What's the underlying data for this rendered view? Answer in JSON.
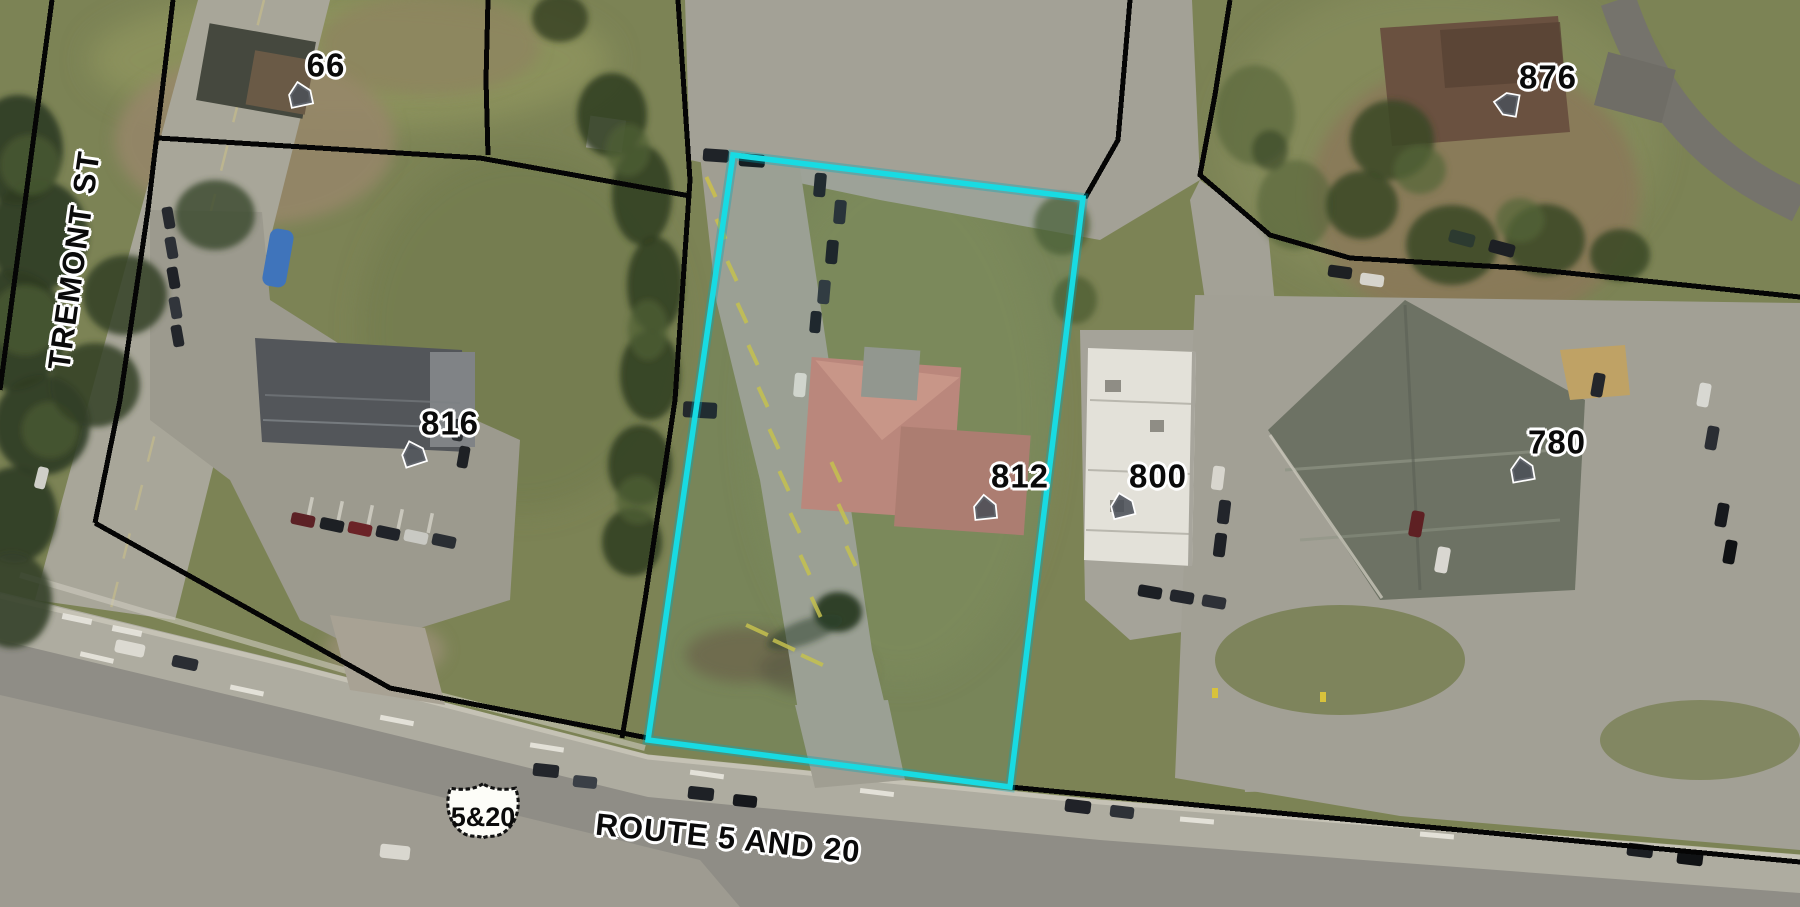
{
  "map": {
    "type": "aerial-parcel-view",
    "streets": {
      "vertical": "TREMONT ST",
      "horizontal": "ROUTE 5 AND 20"
    },
    "route_shield": {
      "text": "5&20"
    },
    "address_points": [
      {
        "number": "66"
      },
      {
        "number": "876"
      },
      {
        "number": "816"
      },
      {
        "number": "812"
      },
      {
        "number": "800"
      },
      {
        "number": "780"
      }
    ],
    "highlighted_parcel": {
      "address": "812",
      "outline_color": "#18DBE3"
    },
    "colors": {
      "parcel_boundary": "#000000",
      "label_text": "#000000",
      "label_halo": "#FFFFFF"
    },
    "icons": [
      {
        "name": "house-icon",
        "meaning": "address point"
      }
    ]
  }
}
